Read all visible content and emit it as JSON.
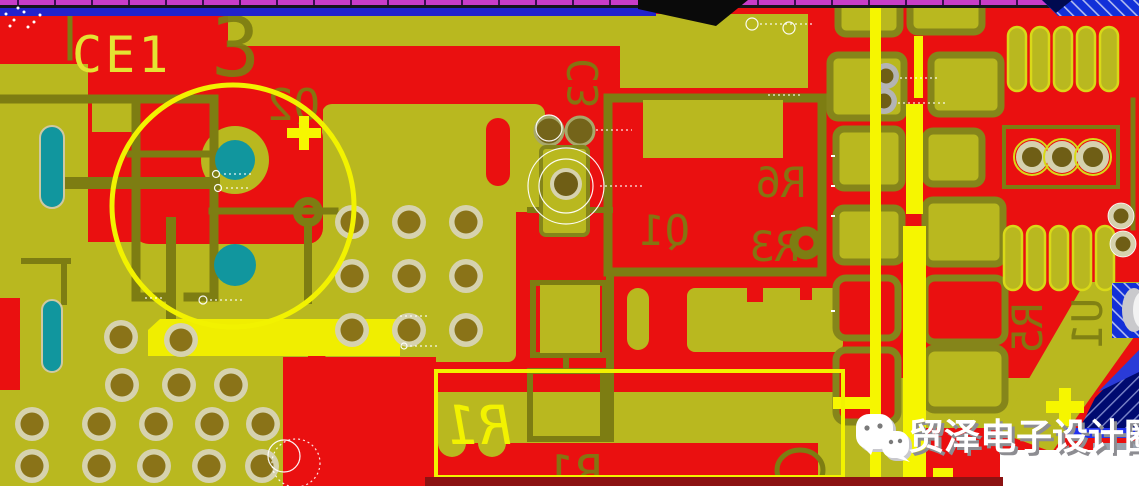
{
  "designators": {
    "ce1": "CE1",
    "num3": "3",
    "q2": "Q2",
    "c3": "C3",
    "r6": "R6",
    "q1": "Q1",
    "r3": "R3",
    "r1_silk": "R1",
    "r1_assembly": "R1",
    "r5": "R5",
    "u1": "U1",
    "plus_top": "+",
    "plus_bottom": "+"
  },
  "watermark": {
    "text": "贸泽电子设计圈",
    "icon": "wechat-icon"
  },
  "colors": {
    "copper_pour_red": "#ea1010",
    "plane_olive": "#b9b81f",
    "outline_dark_olive": "#7d7d12",
    "silkscreen_yellow": "#f2f200",
    "bright_trace_yellow": "#f6f600",
    "via_ring_beige": "#d6d2ae",
    "drill_brown": "#8a7318",
    "inner_layer_teal": "#11969e",
    "board_edge_magenta": "#c83cc8",
    "trace_blue": "#2222cc",
    "hatch_polygon_blue": "#1230d8",
    "navy_polygon": "#000a70",
    "watermark_white": "#ffffff",
    "maroon_strip": "#8c1212"
  }
}
